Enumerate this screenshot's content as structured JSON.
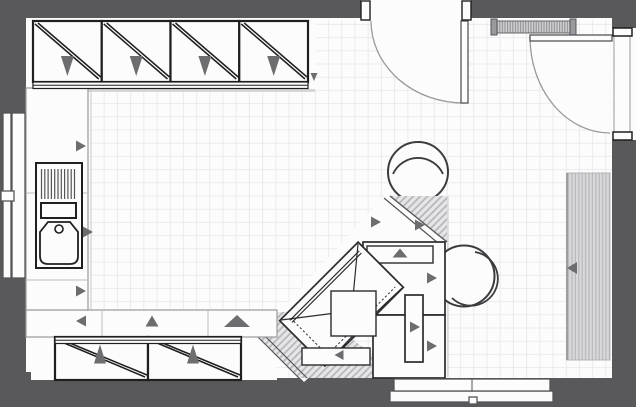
{
  "plan": {
    "colors": {
      "wall": "#59595b",
      "floor": "#fcfcfd",
      "grid": "#ebebee",
      "ink": "#1f1f1f",
      "mid": "#555558",
      "light": "#9a9a9e",
      "faint": "#c9c9cd",
      "shadow": "#d6d6d9",
      "arrow": "#6d6d70",
      "hatch_bg": "#e6e6e8",
      "hatch_line": "#b3b3b6",
      "stripe_bg": "#d9d9db",
      "stripe_line": "#b7b7ba",
      "rail_bg": "#cfcfd2",
      "rail_line": "#8f8f92"
    },
    "floor": {
      "grid": {
        "x0": 91,
        "y0": 24.4,
        "left": 90,
        "top": 20,
        "right": 611.5,
        "bottom": 377.5,
        "size": 13.2
      }
    },
    "top_cabinets": {
      "name": "wall-cabinet-top",
      "x": 33,
      "y": 21,
      "unit_width": 68.75,
      "unit_height": 61,
      "count": 4
    },
    "bottom_cabinets": {
      "name": "wall-cabinet-bottom",
      "x": 55,
      "y": 337,
      "unit_width": 93,
      "unit_height": 43,
      "count": 2
    },
    "chairs": [
      {
        "name": "round-chair-top",
        "cx": 418,
        "cy": 172,
        "r": 30,
        "back_path": "M 393 174 A 27.5 27.5 0 0 1 443 174"
      },
      {
        "name": "round-chair-right",
        "cx": 464,
        "cy": 276,
        "r": 30.5,
        "back_path": "M 475 252 A 27 27 0 1 1 452 298"
      }
    ],
    "sink": {
      "drain": {
        "x0": 41.5,
        "step": 3.3,
        "count": 11,
        "y1": 169,
        "y2": 199
      }
    },
    "arrows": [
      {
        "name": "cabinet-open-arrow",
        "cx": 67.4,
        "cy": 66,
        "dir": "down",
        "w": 13,
        "l": 20
      },
      {
        "name": "cabinet-open-arrow",
        "cx": 136.2,
        "cy": 66,
        "dir": "down",
        "w": 13,
        "l": 20
      },
      {
        "name": "cabinet-open-arrow",
        "cx": 204.9,
        "cy": 66,
        "dir": "down",
        "w": 13,
        "l": 20
      },
      {
        "name": "cabinet-open-arrow",
        "cx": 273.7,
        "cy": 66,
        "dir": "down",
        "w": 13,
        "l": 20
      },
      {
        "name": "cabinet-open-arrow",
        "cx": 314,
        "cy": 77,
        "dir": "down",
        "w": 7,
        "l": 8
      },
      {
        "name": "counter-open-arrow",
        "cx": 81,
        "cy": 146,
        "dir": "right",
        "w": 11,
        "l": 10
      },
      {
        "name": "counter-open-arrow",
        "cx": 88,
        "cy": 232,
        "dir": "right",
        "w": 11,
        "l": 10
      },
      {
        "name": "counter-open-arrow",
        "cx": 81,
        "cy": 291,
        "dir": "right",
        "w": 11,
        "l": 10
      },
      {
        "name": "counter-open-arrow",
        "cx": 81,
        "cy": 321,
        "dir": "left",
        "w": 11,
        "l": 10
      },
      {
        "name": "counter-open-arrow",
        "cx": 152,
        "cy": 321,
        "dir": "up",
        "w": 13,
        "l": 11
      },
      {
        "name": "counter-open-arrow",
        "cx": 237,
        "cy": 321,
        "dir": "up",
        "w": 26,
        "l": 12
      },
      {
        "name": "cabinet-open-arrow",
        "cx": 100,
        "cy": 354,
        "dir": "up",
        "w": 12,
        "l": 19
      },
      {
        "name": "cabinet-open-arrow",
        "cx": 193,
        "cy": 354,
        "dir": "up",
        "w": 12,
        "l": 19
      },
      {
        "name": "counter-open-arrow",
        "cx": 376,
        "cy": 222,
        "dir": "right",
        "w": 11,
        "l": 10
      },
      {
        "name": "counter-open-arrow",
        "cx": 420,
        "cy": 225,
        "dir": "right",
        "w": 11,
        "l": 10
      },
      {
        "name": "drawer-open-arrow",
        "cx": 400,
        "cy": 253,
        "dir": "up",
        "w": 15,
        "l": 9
      },
      {
        "name": "counter-open-arrow",
        "cx": 432,
        "cy": 278,
        "dir": "right",
        "w": 11,
        "l": 10
      },
      {
        "name": "counter-open-arrow",
        "cx": 415,
        "cy": 327,
        "dir": "right",
        "w": 11,
        "l": 10
      },
      {
        "name": "counter-open-arrow",
        "cx": 432,
        "cy": 346,
        "dir": "right",
        "w": 11,
        "l": 10
      },
      {
        "name": "drawer-open-arrow",
        "cx": 339,
        "cy": 355,
        "dir": "left",
        "w": 10,
        "l": 9
      },
      {
        "name": "radiator-arrow",
        "cx": 572,
        "cy": 268,
        "dir": "left",
        "w": 12,
        "l": 10
      }
    ],
    "items": [
      "wall-cabinet-row-top",
      "left-counter-run",
      "sink-with-drainer",
      "bottom-counter-run",
      "wall-cabinet-row-bottom",
      "diagonal-peninsula",
      "corner-armchair",
      "island-cabinet-blocks",
      "tall-cabinet-front",
      "round-chair-top",
      "round-chair-right",
      "entry-door-top",
      "entry-door-right",
      "window-left",
      "window-bottom",
      "wall-rail-top",
      "radiator-right"
    ]
  }
}
